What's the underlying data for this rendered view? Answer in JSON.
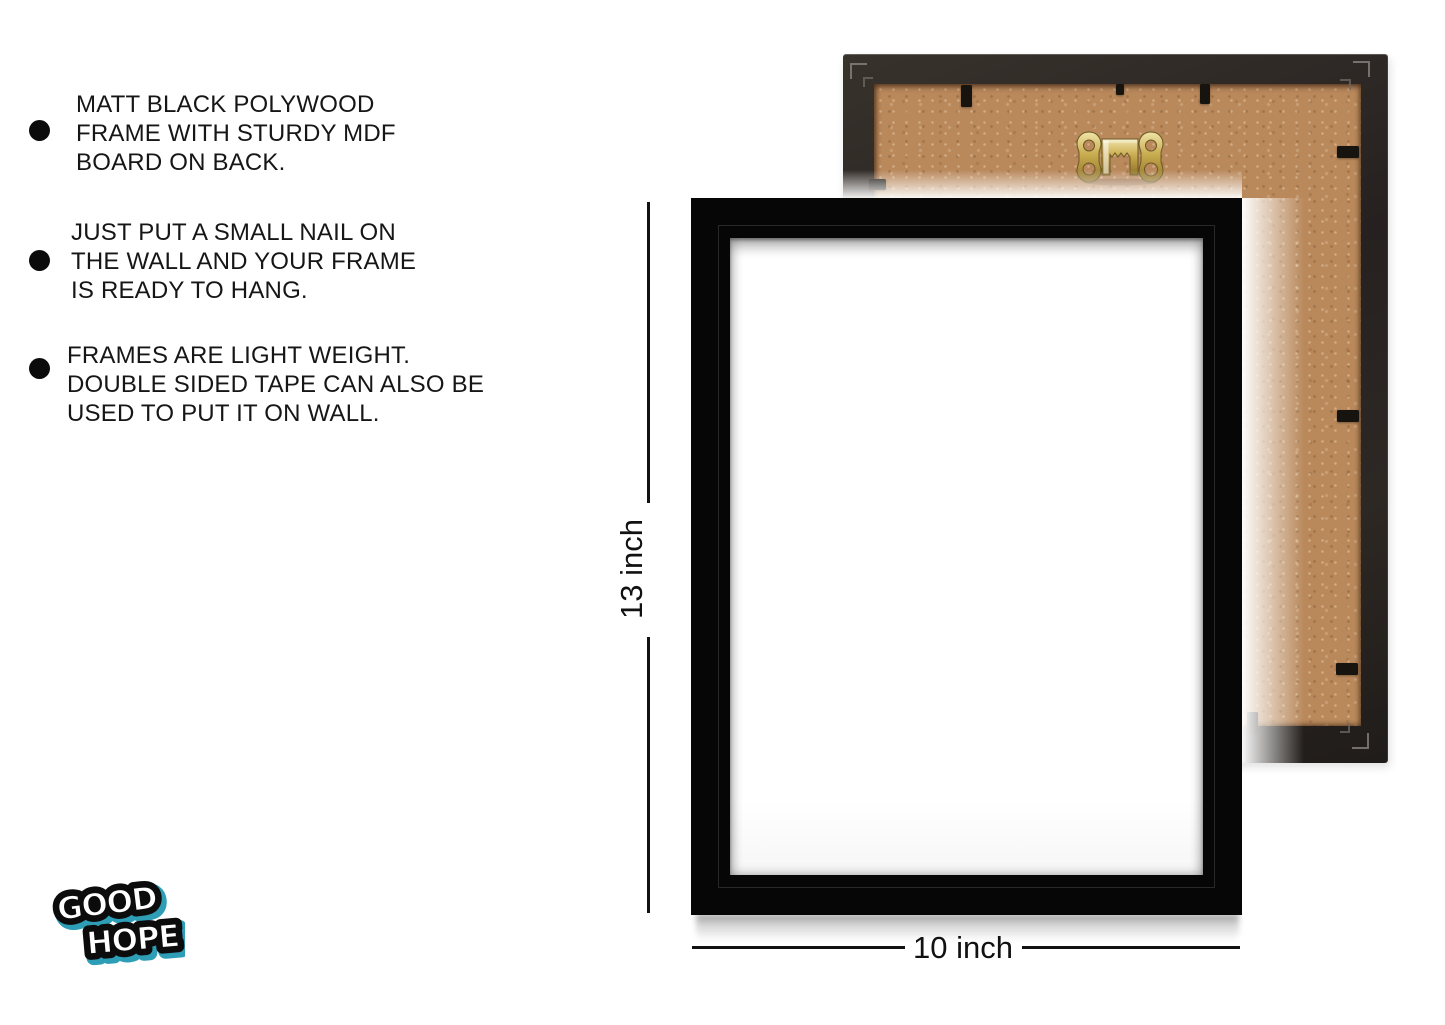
{
  "features": {
    "items": [
      {
        "lines": [
          "MATT BLACK POLYWOOD",
          "FRAME WITH STURDY MDF",
          "BOARD ON BACK."
        ]
      },
      {
        "lines": [
          "JUST PUT A SMALL NAIL ON",
          "THE WALL AND YOUR FRAME",
          "IS READY TO HANG."
        ]
      },
      {
        "lines": [
          "FRAMES ARE LIGHT WEIGHT.",
          "DOUBLE SIDED TAPE CAN ALSO BE",
          "USED TO PUT IT ON WALL."
        ]
      }
    ]
  },
  "dimensions": {
    "height_label": "13 inch",
    "width_label": "10 inch"
  },
  "brand": {
    "logo_line1": "GOOD",
    "logo_line2": "HOPE"
  },
  "colors": {
    "front_frame": "#060606",
    "back_frame_border": "#292420",
    "mdf_board": "#b9895c",
    "hanger_gold": "#c9ab4f",
    "logo_accent": "#2e9db6",
    "text": "#161616"
  }
}
